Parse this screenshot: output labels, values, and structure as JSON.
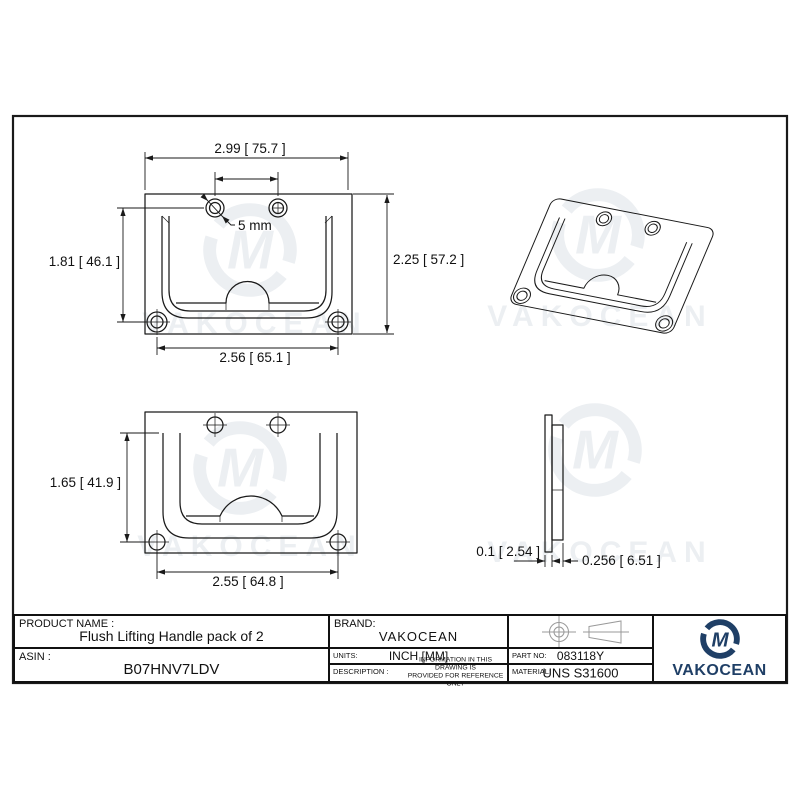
{
  "drawing": {
    "views": {
      "front": {
        "dim_width": "2.99 [ 75.7 ]",
        "dim_height": "2.25 [ 57.2 ]",
        "dim_hole_span": "1.81 [ 46.1 ]",
        "dim_hole_pitch": "2.56 [ 65.1 ]",
        "hole_diameter": "5 mm"
      },
      "rear": {
        "dim_height": "1.65 [ 41.9 ]",
        "dim_width": "2.55 [ 64.8 ]"
      },
      "side": {
        "dim_thickness": "0.1 [ 2.54 ]",
        "dim_depth": "0.256 [ 6.51 ]"
      }
    },
    "watermark_text": "VAKOCEAN",
    "watermark_monogram": "M"
  },
  "title_block": {
    "product_name_label": "PRODUCT NAME :",
    "product_name": "Flush Lifting Handle pack of 2",
    "asin_label": "ASIN :",
    "asin": "B07HNV7LDV",
    "brand_label": "BRAND:",
    "brand": "VAKOCEAN",
    "units_label": "UNITS:",
    "units": "INCH [MM]",
    "description_label": "DESCRIPTION :",
    "description_line1": "INFORMATION IN THIS DRAWING IS",
    "description_line2": "PROVIDED FOR REFERENCE ONLY",
    "part_no_label": "PART  NO:",
    "part_no": "083118Y",
    "material_label": "MATERIAL:",
    "material": "UNS S31600"
  },
  "logo": {
    "wordmark": "VAKOCEAN",
    "monogram": "M"
  },
  "colors": {
    "line": "#1a1a1a",
    "projection_symbol": "#999999",
    "logo_navy": "#1f3f66",
    "watermark": "#eceff2"
  }
}
